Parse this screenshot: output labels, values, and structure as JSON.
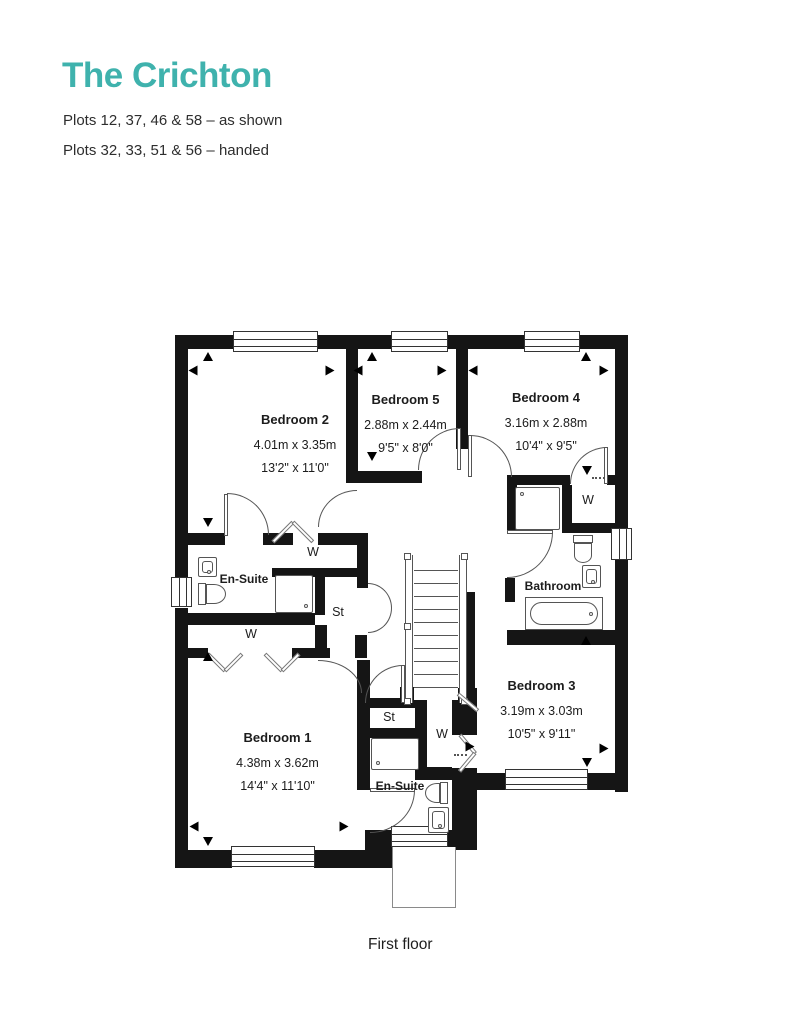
{
  "header": {
    "title": "The Crichton",
    "plots_as_shown": "Plots 12, 37, 46 & 58 – as shown",
    "plots_handed": "Plots 32, 33, 51 & 56 – handed"
  },
  "caption": "First floor",
  "colors": {
    "accent": "#3fb2ad",
    "wall": "#151515",
    "text": "#1c1c1c"
  },
  "plan": {
    "rooms": [
      {
        "id": "bedroom-2",
        "name": "Bedroom 2",
        "metric": "4.01m x 3.35m",
        "imperial": "13'2\" x 11'0\""
      },
      {
        "id": "bedroom-5",
        "name": "Bedroom 5",
        "metric": "2.88m x 2.44m",
        "imperial": "9'5\" x 8'0\""
      },
      {
        "id": "bedroom-4",
        "name": "Bedroom 4",
        "metric": "3.16m x 2.88m",
        "imperial": "10'4\" x 9'5\""
      },
      {
        "id": "bedroom-3",
        "name": "Bedroom 3",
        "metric": "3.19m x 3.03m",
        "imperial": "10'5\" x 9'11\""
      },
      {
        "id": "bedroom-1",
        "name": "Bedroom 1",
        "metric": "4.38m x 3.62m",
        "imperial": "14'4\" x 11'10\""
      }
    ],
    "labels": {
      "ensuite": "En-Suite",
      "bathroom": "Bathroom",
      "wardrobe": "W",
      "store": "St"
    }
  }
}
